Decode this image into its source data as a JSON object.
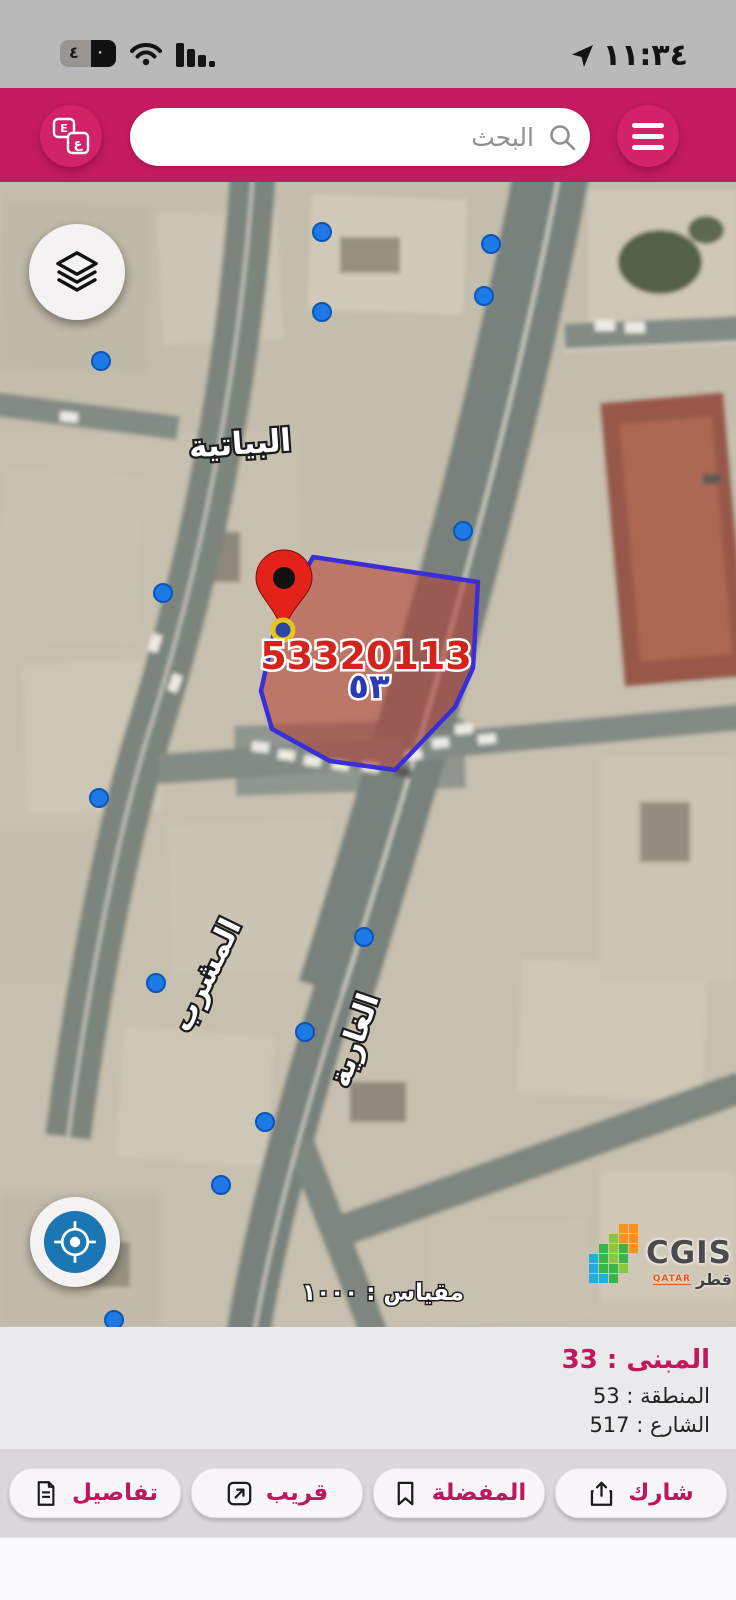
{
  "status_bar": {
    "time": "١١:٣٤",
    "battery_tens": "٤",
    "battery_ones": "٠"
  },
  "header": {
    "search_placeholder": "البحث",
    "translate_top": "E",
    "translate_bottom": "ع"
  },
  "map": {
    "area_label": "البياتية",
    "street_label_1": "المشرب",
    "street_label_2": "الغارية",
    "parcel_number": "53320113",
    "zone_number_ar": "٥٣",
    "scale_text": "مقياس : ١٠٠٠",
    "logo": {
      "name": "CGIS",
      "country_ar": "قطر",
      "country_en": "QATAR"
    },
    "markers": [
      {
        "x": 322,
        "y": 50
      },
      {
        "x": 322,
        "y": 130
      },
      {
        "x": 491,
        "y": 62
      },
      {
        "x": 484,
        "y": 114
      },
      {
        "x": 101,
        "y": 179
      },
      {
        "x": 163,
        "y": 411
      },
      {
        "x": 463,
        "y": 349
      },
      {
        "x": 99,
        "y": 616
      },
      {
        "x": 364,
        "y": 755
      },
      {
        "x": 156,
        "y": 801
      },
      {
        "x": 305,
        "y": 850
      },
      {
        "x": 265,
        "y": 940
      },
      {
        "x": 221,
        "y": 1003
      },
      {
        "x": 114,
        "y": 1138
      }
    ],
    "selected_marker": {
      "x": 283,
      "y": 448
    }
  },
  "info_panel": {
    "building_line": "المبنى : 33",
    "zone_line": "المنطقة : 53",
    "street_line": "الشارع : 517"
  },
  "actions": [
    {
      "label": "تفاصيل",
      "icon": "document-icon"
    },
    {
      "label": "قريب",
      "icon": "external-arrow-icon"
    },
    {
      "label": "المفضلة",
      "icon": "bookmark-icon"
    },
    {
      "label": "شارك",
      "icon": "share-icon"
    }
  ],
  "colors": {
    "accent": "#c2185b",
    "header": "#c41a60",
    "marker_blue": "#1d79e6",
    "parcel_fill": "#b23a30",
    "parcel_stroke": "#3a2fd6",
    "pin_red": "#e32219",
    "selected_ring": "#e8c51d"
  }
}
